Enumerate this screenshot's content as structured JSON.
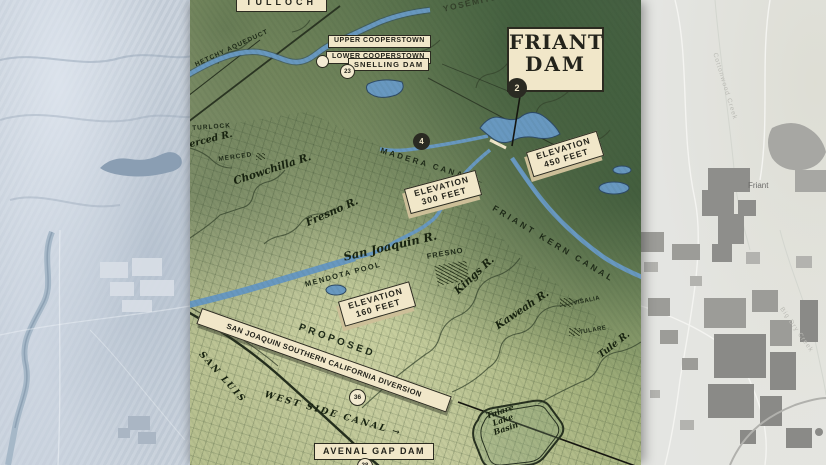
{
  "old_map": {
    "boxed_labels": {
      "tulloch": "TULLOCH",
      "upper_cooperstown": "UPPER COOPERSTOWN",
      "lower_cooperstown": "LOWER COOPERSTOWN",
      "snelling_dam": "SNELLING DAM",
      "avenal_gap_dam": "AVENAL GAP DAM",
      "diversion_banner": "SAN JOAQUIN SOUTHERN CALIFORNIA DIVERSION"
    },
    "friant_dam": {
      "l1": "FRIANT",
      "l2": "DAM"
    },
    "elevation_450": {
      "l1": "ELEVATION",
      "l2": "450 FEET"
    },
    "elevation_300": {
      "l1": "ELEVATION",
      "l2": "300 FEET"
    },
    "elevation_160": {
      "l1": "ELEVATION",
      "l2": "160 FEET"
    },
    "tulare_lake_basin": {
      "l1": "Tulare",
      "l2": "Lake",
      "l3": "Basin"
    },
    "place_labels": {
      "yosemite_valley": "YOSEMITE VALLEY",
      "proposed": "PROPOSED",
      "turlock": "TURLOCK",
      "merced": "MERCED",
      "fresno": "FRESNO",
      "visalia": "VISALIA",
      "tulare": "TULARE",
      "mendota_pool": "MENDOTA POOL"
    },
    "river_labels": {
      "merced_r": "Merced R.",
      "chowchilla_r": "Chowchilla R.",
      "fresno_r": "Fresno R.",
      "san_joaquin_r": "San Joaquin R.",
      "kings_r": "Kings R.",
      "kaweah_r": "Kaweah R.",
      "tule_r": "Tule R."
    },
    "canal_labels": {
      "hetchy_aqueduct": "HETCHY AQUEDUCT",
      "madera_canal": "MADERA CANAL ←",
      "friant_kern_canal": "FRIANT KERN CANAL",
      "san_luis": "SAN LUIS",
      "west_side_canal": "WEST SIDE CANAL →"
    },
    "markers": {
      "friant_dam_unit": "2",
      "madera_canal_unit": "4",
      "snelling_dam_unit": "23",
      "diversion_unit": "36",
      "avenal_unit": "38"
    },
    "colors": {
      "label_cream": "#f1e7c9",
      "ink_dark": "#2b2b20",
      "water_blue": "#6898c0",
      "valley_green": "#c2c89a",
      "mountain_green": "#50694a"
    }
  },
  "modern_map": {
    "labels": {
      "friant_town": "Friant",
      "cottonwood_creek": "Cottonwood Creek",
      "big_dry_creek": "Big Dry Creek"
    },
    "colors": {
      "base_gray": "#e4e5e2",
      "urban_gray": "#8e8e8b"
    }
  }
}
